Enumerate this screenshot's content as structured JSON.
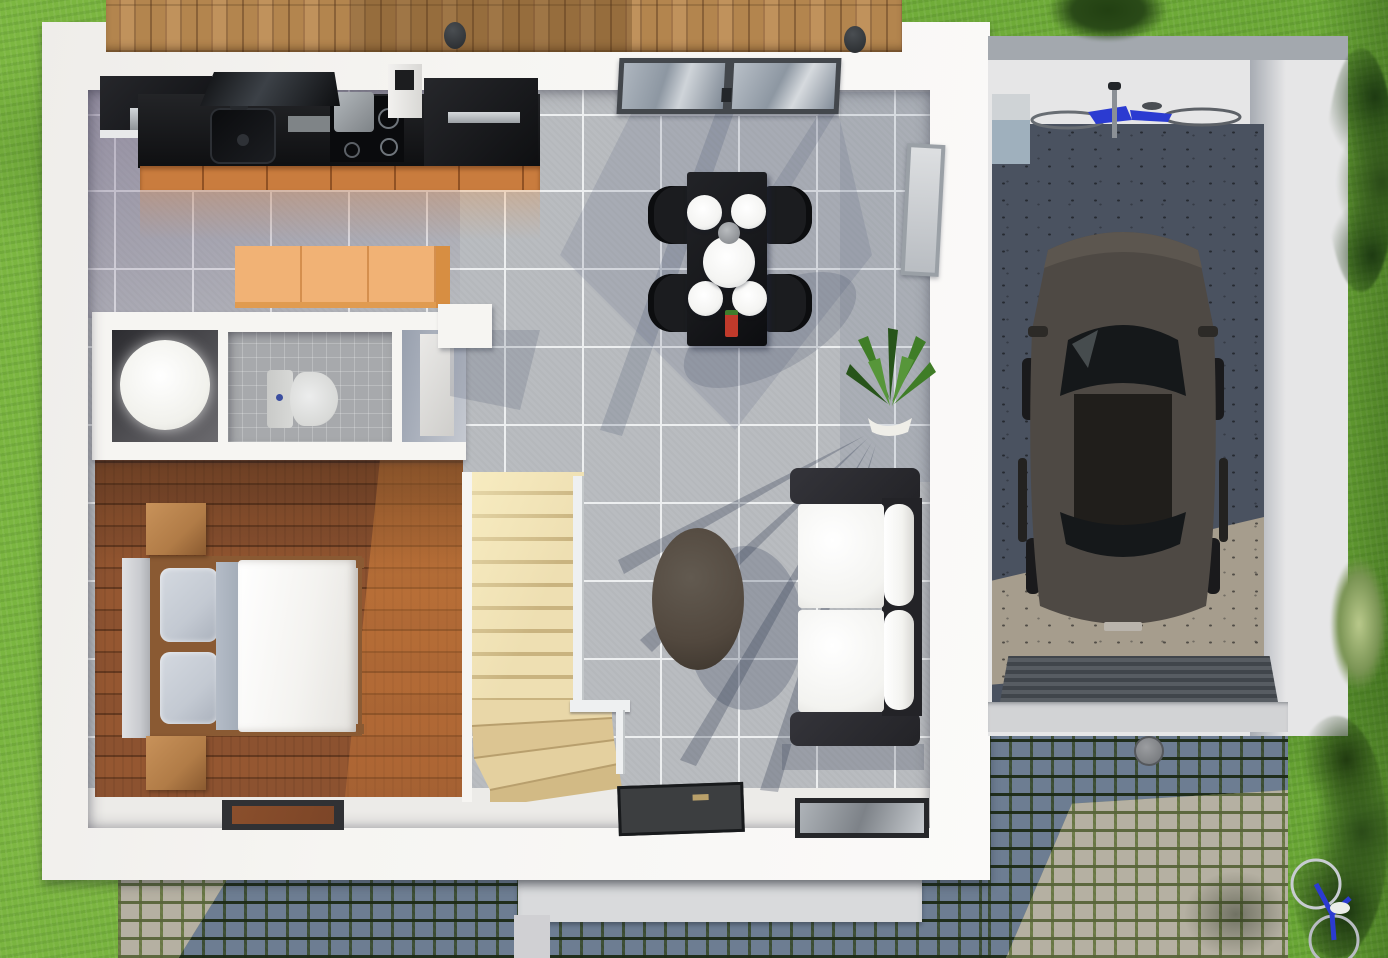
{
  "scene": {
    "type": "3d-floor-plan-render",
    "view": "top-down",
    "description": "Top-down 3D architectural render of a small house interior with attached single garage, wooden deck terrace at top, lawn around, and cobblestone driveway at the bottom",
    "rooms": [
      {
        "name": "kitchen",
        "floor": "gray-tile",
        "objects": [
          "wall-cabinet",
          "counter",
          "sink",
          "faucet",
          "cooktop",
          "pot",
          "range-hood",
          "vent-chimney",
          "refrigerator",
          "sideboard-cabinet"
        ]
      },
      {
        "name": "dining-area",
        "floor": "gray-tile",
        "objects": [
          "dining-table",
          "dining-chair-x4",
          "plate-x4",
          "serving-plate",
          "bowl",
          "condiment-bottle",
          "top-window",
          "side-window",
          "houseplant"
        ]
      },
      {
        "name": "living-area",
        "floor": "gray-tile",
        "objects": [
          "sofa",
          "seat-cushion-x2",
          "back-cushion-x2",
          "coffee-table",
          "entry-mat",
          "floor-glass-panel"
        ]
      },
      {
        "name": "bathroom",
        "floor": "gray-mosaic",
        "objects": [
          "round-shower",
          "toilet",
          "door-leaf"
        ]
      },
      {
        "name": "bedroom",
        "floor": "hardwood-planks",
        "objects": [
          "double-bed",
          "duvet",
          "pillow-x2",
          "headboard",
          "nightstand-x2",
          "door-mat"
        ]
      },
      {
        "name": "staircase",
        "floor": "light-wood",
        "objects": [
          "straight-flight",
          "winder-steps",
          "railing"
        ]
      },
      {
        "name": "garage",
        "floor": "concrete",
        "objects": [
          "car",
          "bicycle",
          "storage-box",
          "ribbed-entrance-mat",
          "threshold",
          "drain-cap"
        ]
      }
    ],
    "exterior_objects": [
      "lawn",
      "wooden-deck",
      "deck-knob-x2",
      "front-step",
      "cobblestone-paving",
      "driveway",
      "tree-top-right",
      "bush-light",
      "bush-dark-cluster",
      "corner-foliage",
      "lawn-bicycle"
    ]
  },
  "palette": {
    "grass": "#76b33f",
    "grass_dark": "#558c2a",
    "deck_wood": "#b3854e",
    "deck_wood_dark": "#8a6238",
    "house_wall": "#f6f5f2",
    "step": "#d9dadc",
    "tile": "#b9bcc0",
    "grout": "#edeff0",
    "wood_floor": "#8c5230",
    "wood_floor_dark": "#6e3f22",
    "wood_floor_sun": "#c8803f",
    "counter": "#141518",
    "steel": "#c6cacd",
    "orange_wood": "#c97c3e",
    "sideboard": "#f1b275",
    "sideboard_side": "#d78e42",
    "stairs_light": "#eedfb2",
    "stairs_dark": "#c9b37f",
    "railing": "#eef0f1",
    "bed_duvet": "#f4f3f0",
    "bed_pillow": "#c3c9d2",
    "bed_sheet": "#b4bcc7",
    "headboard": "#c9cbcf",
    "nightstand": "#b17c47",
    "bed_frame": "#8a5a33",
    "mat_dark": "#303134",
    "mat_core": "#7c4527",
    "table": "#17181b",
    "chair": "#1b1c1f",
    "plate": "#f4f4f2",
    "bowl": "#8f9296",
    "bottle_red": "#c03a2b",
    "bottle_green": "#3f7d2c",
    "sofa_frame": "#232327",
    "cushion": "#f3f3f0",
    "coffee_table": "#52483e",
    "toilet": "#d8d9d7",
    "shower": "#ffffff",
    "bath_floor": "#a7a9ac",
    "shower_floor": "#39393d",
    "window_frame": "#43474c",
    "glass": "#8d97a2",
    "plant_green": "#3f7d27",
    "plant_dark": "#27541a",
    "pot": "#efeee8",
    "concrete_sun": "#a69d8d",
    "concrete_shadow": "#4a5260",
    "car_body": "#4e4944",
    "car_glass": "#15181a",
    "garage_wall": "#e6e6e7",
    "garage_wall_top": "#a3a8ae",
    "garage_cabinet": "#9fb0bd",
    "cobble_shadow": "#6d7d92",
    "cobble_sun": "#b5b0a2",
    "moss_shadow": "#3f5138",
    "moss_sun": "#6e7c49",
    "bike_blue": "#2b3bd1",
    "threshold": "#d2d3d5",
    "garage_mat": "#4b5056",
    "bush_dark": "#2a4a18",
    "bush_light": "#b9c98b"
  }
}
